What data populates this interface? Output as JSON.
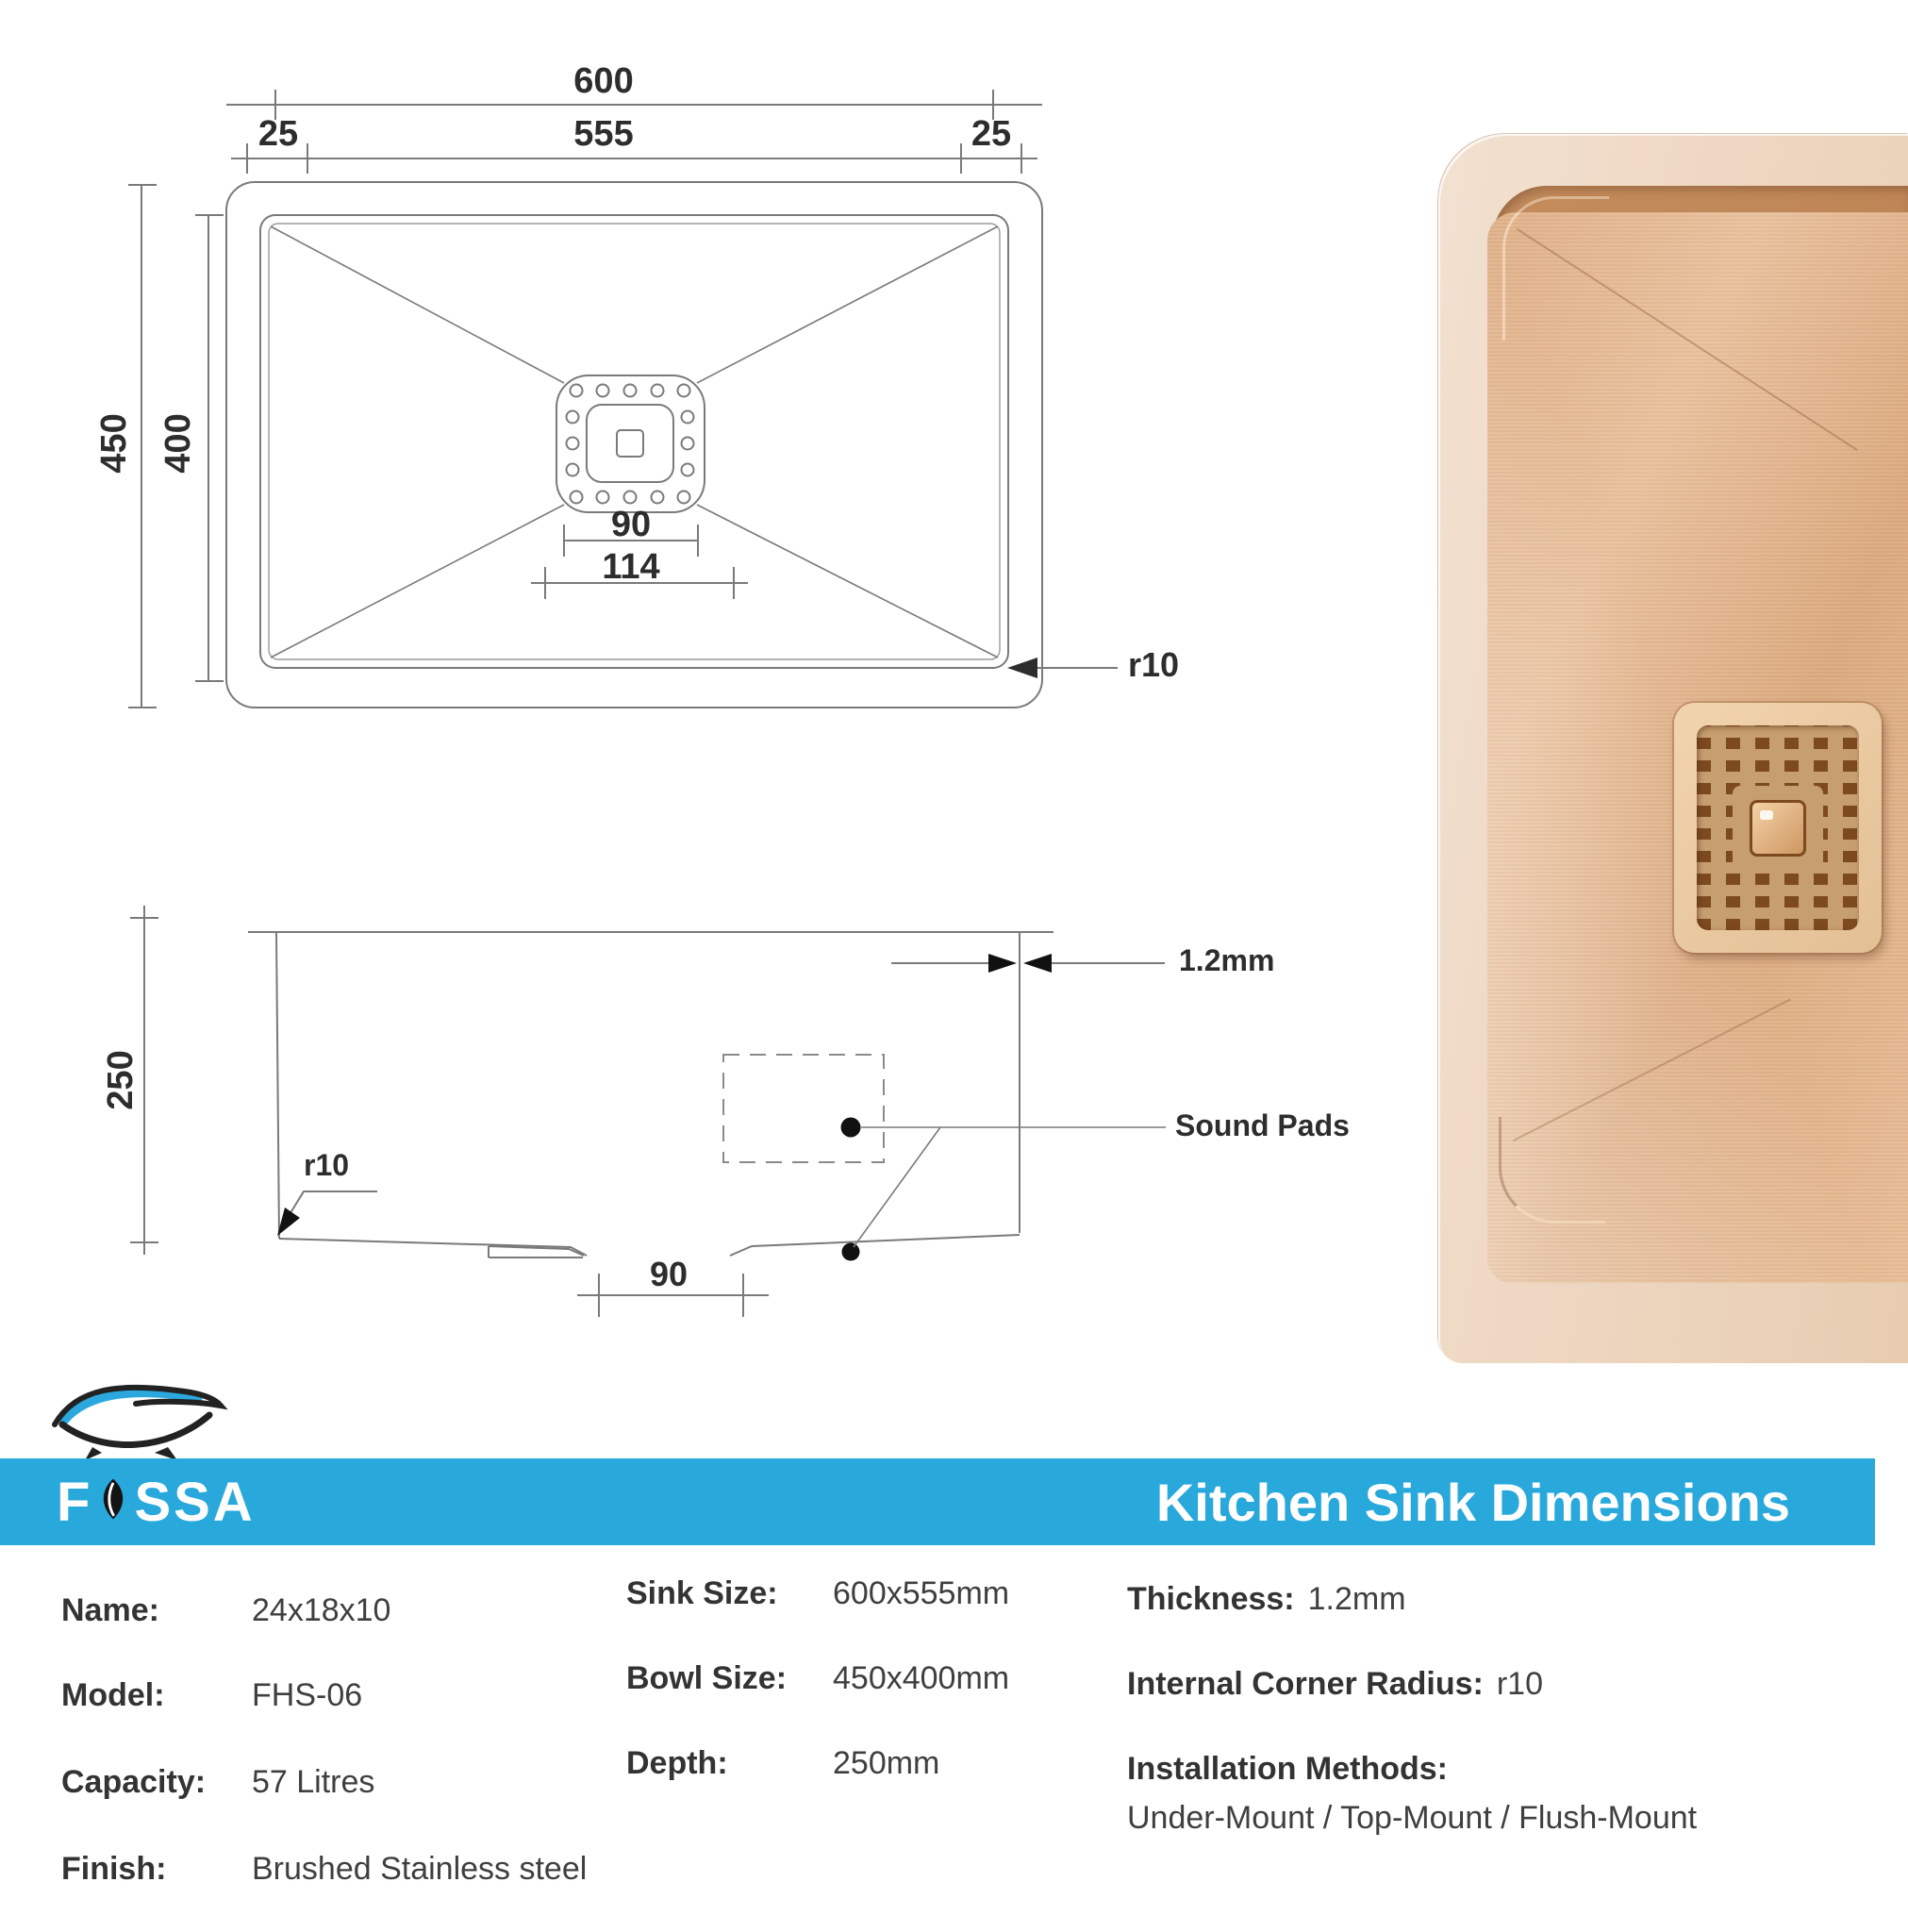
{
  "brand": {
    "name": "FOSSA",
    "wordmark_left": "F",
    "wordmark_right": "SSA"
  },
  "header": {
    "title": "Kitchen Sink Dimensions",
    "band_color": "#29a8dc"
  },
  "top_view": {
    "dims": {
      "overall_width": "600",
      "bowl_width": "555",
      "flange_left": "25",
      "flange_right": "25",
      "overall_depth": "450",
      "bowl_depth": "400",
      "drain_width": "90",
      "drain_plate_width": "114",
      "corner_radius": "r10"
    }
  },
  "side_view": {
    "dims": {
      "depth": "250",
      "corner_radius": "r10",
      "drain_width": "90",
      "wall_thickness": "1.2mm"
    },
    "label_sound_pads": "Sound Pads"
  },
  "specs": {
    "col1": [
      {
        "label": "Name:",
        "value": "24x18x10"
      },
      {
        "label": "Model:",
        "value": "FHS-06"
      },
      {
        "label": "Capacity:",
        "value": "57 Litres"
      },
      {
        "label": "Finish:",
        "value": "Brushed Stainless steel"
      }
    ],
    "col2": [
      {
        "label": "Sink Size:",
        "value": "600x555mm"
      },
      {
        "label": "Bowl Size:",
        "value": "450x400mm"
      },
      {
        "label": "Depth:",
        "value": "250mm"
      }
    ],
    "col3": [
      {
        "label": "Thickness:",
        "value": "1.2mm"
      },
      {
        "label": "Internal Corner Radius:",
        "value": "r10"
      },
      {
        "label": "Installation Methods:",
        "value": "Under-Mount / Top-Mount / Flush-Mount"
      }
    ]
  },
  "colors": {
    "accent_blue": "#29a8dc",
    "line_gray": "#7a7a7a",
    "text_dark": "#2d2d2d",
    "copper_rim": "#eed7c2",
    "copper_wall": "#b97e4e",
    "copper_floor": "#e0b28a"
  }
}
